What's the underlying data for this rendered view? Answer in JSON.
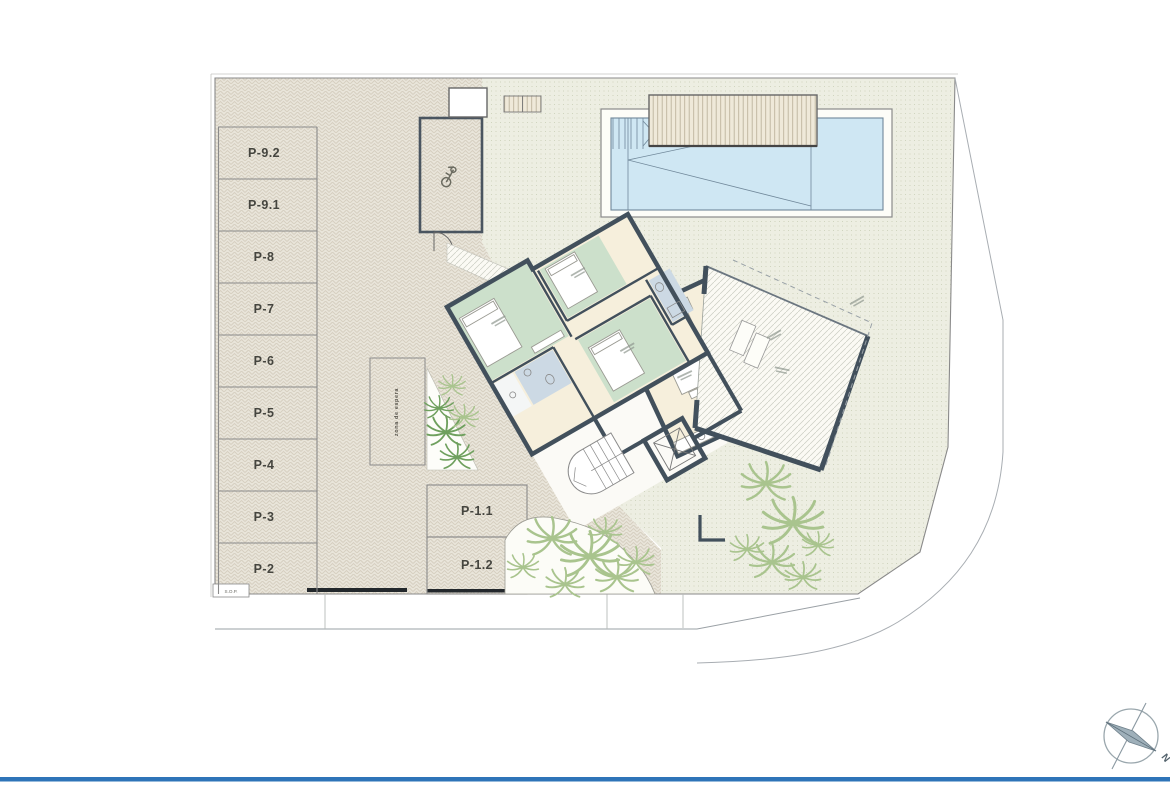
{
  "plan": {
    "title_context": "villa site plan with parking level",
    "parking_left": [
      "P-9.2",
      "P-9.1",
      "P-8",
      "P-7",
      "P-6",
      "P-5",
      "P-4",
      "P-3",
      "P-2"
    ],
    "parking_bottom": [
      "P-1.1",
      "P-1.2"
    ],
    "waiting_zone_label": "zona de espera",
    "footer_mark_label": "S.O.P.",
    "compass_north_label": "N",
    "icons": [
      "scooter-icon",
      "compass-rose-icon"
    ],
    "colors": {
      "paving_base": "#e9e5da",
      "paving_line": "#d5cebf",
      "garden_base": "#edeee2",
      "garden_dot": "#c9ceb5",
      "wall": "#42505c",
      "bedroom": "#cce0cb",
      "bathroom": "#ccd9e4",
      "living": "#f6efdc",
      "pool_water": "#cfe7f3",
      "pool_line": "#70889a",
      "palm_light": "#a9c48e",
      "palm_dark": "#6fa05e",
      "accent_line": "#2e74b8",
      "label_text": "#45453f"
    }
  }
}
